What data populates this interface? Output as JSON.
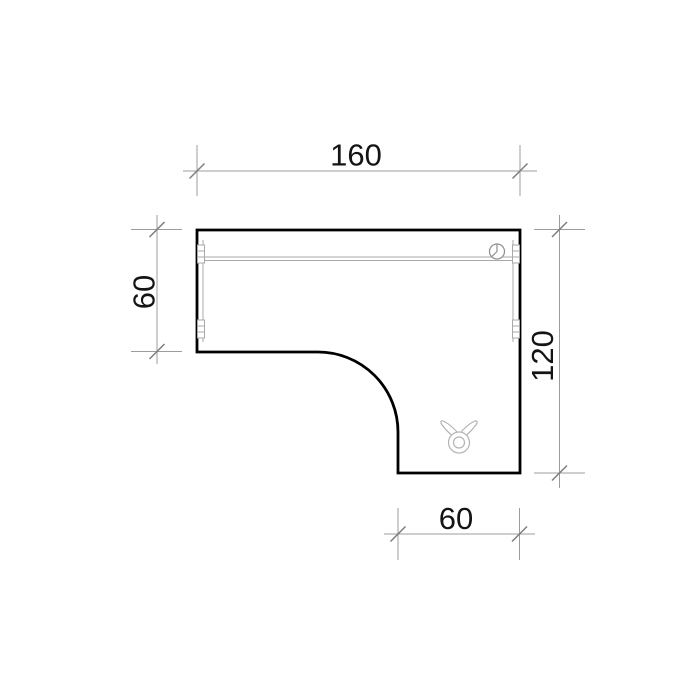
{
  "drawing": {
    "colors": {
      "background": "#ffffff",
      "outline": "#000000",
      "detail": "#a9a9a9",
      "grommet": "#8f8f8f",
      "icon": "#b3b3b3",
      "dim": "#9c9c9c",
      "tick": "#7d7d7d",
      "text": "#141414"
    },
    "dimensions": {
      "top": {
        "label": "160"
      },
      "left": {
        "label": "60"
      },
      "right": {
        "label": "120"
      },
      "bottom": {
        "label": "60"
      }
    },
    "icons": {
      "grommet": "cable-grommet-icon",
      "clip": "cable-clip-icon"
    }
  }
}
